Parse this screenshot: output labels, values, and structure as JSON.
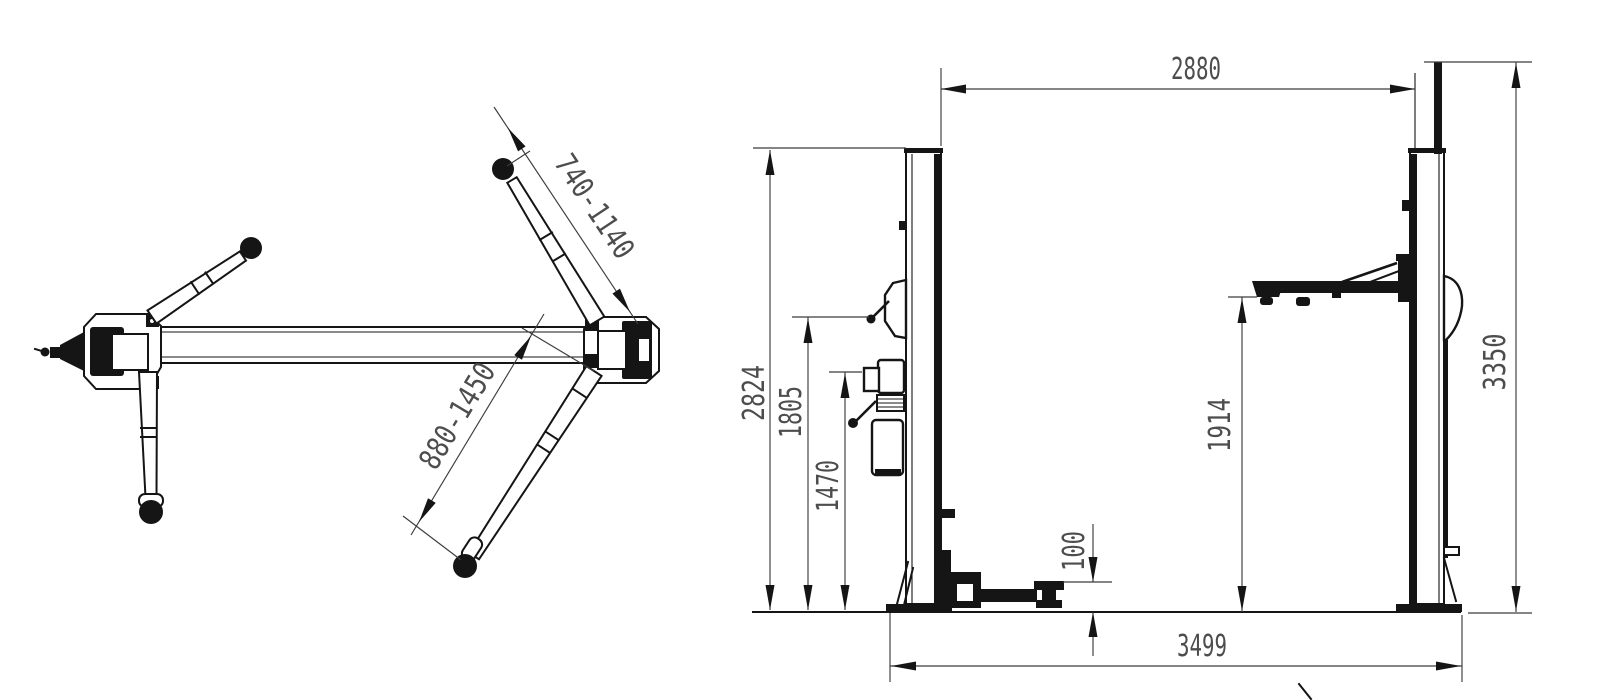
{
  "drawing": {
    "type": "two-post car lift dimensional drawing",
    "colors": {
      "background": "#ffffff",
      "geometry_line": "#151515",
      "dimension_line": "#3c3c3c",
      "dimension_text": "#4d4d4d"
    },
    "plan_view": {
      "description": "top view of base beam and swing arms",
      "dims": {
        "short_arm_reach": "740-1140",
        "long_arm_reach": "880-1450"
      }
    },
    "front_view": {
      "description": "front view of two-post lift",
      "dims": {
        "clear_width": "2880",
        "column_height": "2824",
        "pivot_height": "1805",
        "power_unit_height": "1470",
        "lifting_height": "1914",
        "min_pad_height": "100",
        "overall_height": "3350",
        "overall_width": "3499"
      }
    }
  }
}
